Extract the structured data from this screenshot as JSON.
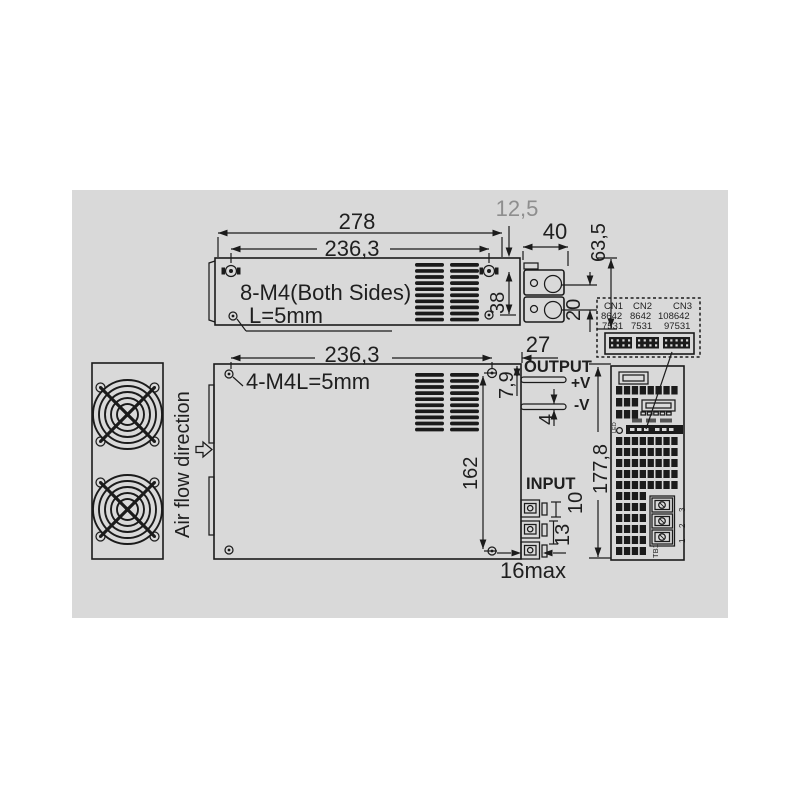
{
  "side_view": {
    "dim_width_outer": "278",
    "dim_width_holes": "236,3",
    "dim_edge_offset": "12,5",
    "dim_bracket_width": "40",
    "dim_height": "63,5",
    "dim_hole_span": "38",
    "dim_plate_span": "20",
    "label_mounting": "8-M4(Both Sides)",
    "label_screw_length": "L=5mm"
  },
  "plan_view": {
    "dim_width_holes": "236,3",
    "dim_edge_offset": "27",
    "dim_hole_span": "162",
    "dim_depth": "177,8",
    "dim_output_offset": "7,9",
    "dim_busbar_thickness": "4",
    "dim_pin_pitch_upper": "10",
    "dim_pin_pitch_lower": "13",
    "dim_terminal_protrusion": "16max",
    "label_mounting": "4-M4L=5mm",
    "label_output": "OUTPUT",
    "label_plus_v": "+V",
    "label_minus_v": "-V",
    "label_input": "INPUT",
    "label_airflow": "Air flow direction"
  },
  "connector_detail": {
    "cn1_label": "CN1",
    "cn2_label": "CN2",
    "cn3_label": "CN3",
    "cn1_top": "8642",
    "cn2_top": "8642",
    "cn3_top": "108642",
    "cn1_bottom": "7531",
    "cn2_bottom": "7531",
    "cn3_bottom": "97531"
  },
  "front_view": {
    "label_led": "LED",
    "label_tb1": "TB1",
    "terminal_3": "3",
    "terminal_2": "2",
    "terminal_1": "1"
  },
  "colors": {
    "background": "#d9d9d9",
    "line": "#1b1b1b",
    "dim_gray_text": "#8e8e8e"
  }
}
